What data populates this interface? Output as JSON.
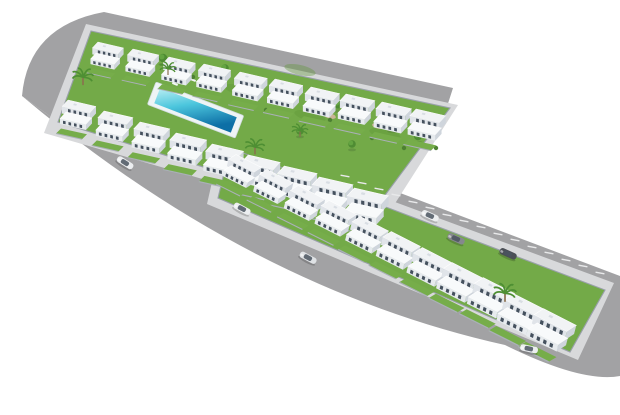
{
  "scene": {
    "description": "Aerial 3D architectural rendering of a modern white residential development: an upper block with two rows of villas around a communal lawn and rectangular swimming pool, a lower terrace row of townhouses with a rear parking lane, all wrapped by wide gray roads with rounded corners on a plain white ground, with a few cars and palm trees",
    "view": "aerial-perspective",
    "counts": {
      "villas_back_row": 10,
      "villas_front_row": 9,
      "townhouses": 11,
      "parking_space_lines": 16,
      "cars": 7,
      "palm_trees": 5,
      "garden_trees": 8,
      "pools": 1
    }
  },
  "colors": {
    "background": "#ffffff",
    "road": "#a2a2a4",
    "sidewalk": "#d8d9db",
    "lawn": "#73aa48",
    "lawn_shade": "#5f9638",
    "pool_deck": "#eef4f5",
    "pool_shallow": "#b9eef3",
    "pool_mid": "#4cc6dd",
    "pool_deep": "#0d6fa6",
    "house_roof": "#f1f3f5",
    "house_face": "#e0e4e9",
    "house_side": "#cfd5dc",
    "terrace_roof": "#f8fafb",
    "terrace_face": "#e7ebee",
    "window": "#45515e",
    "parking_line": "#e8e9ea",
    "tree_dark": "#4f8c33",
    "tree_light": "#63a441",
    "palm_frond": "#4e8f33",
    "palm_trunk": "#8a6f4e",
    "bush": "#4d8032",
    "dirt": "#c9b497",
    "car_white": "#eceef0",
    "car_silver": "#dfe2e5",
    "car_gray": "#85888d",
    "car_dark": "#4b4f56"
  },
  "items": {
    "villas_back": [
      {
        "x": 96,
        "y": 42,
        "s": 0.92
      },
      {
        "x": 131,
        "y": 49,
        "s": 0.93
      },
      {
        "x": 167,
        "y": 57,
        "s": 0.95
      },
      {
        "x": 202,
        "y": 64,
        "s": 0.96
      },
      {
        "x": 238,
        "y": 72,
        "s": 0.98
      },
      {
        "x": 273,
        "y": 79,
        "s": 1.0
      },
      {
        "x": 309,
        "y": 87,
        "s": 1.02
      },
      {
        "x": 344,
        "y": 94,
        "s": 1.03
      },
      {
        "x": 380,
        "y": 102,
        "s": 1.05
      },
      {
        "x": 414,
        "y": 109,
        "s": 1.06
      }
    ],
    "villas_front": [
      {
        "x": 66,
        "y": 100,
        "s": 1.0
      },
      {
        "x": 102,
        "y": 111,
        "s": 1.03
      },
      {
        "x": 138,
        "y": 122,
        "s": 1.06
      },
      {
        "x": 174,
        "y": 133,
        "s": 1.09
      },
      {
        "x": 210,
        "y": 144,
        "s": 1.12
      },
      {
        "x": 246,
        "y": 155,
        "s": 1.14
      },
      {
        "x": 282,
        "y": 166,
        "s": 1.17
      },
      {
        "x": 317,
        "y": 177,
        "s": 1.2
      },
      {
        "x": 352,
        "y": 188,
        "s": 1.22
      }
    ],
    "townhouses": [
      {
        "x": 234,
        "y": 154,
        "s": 1.0,
        "r": 14
      },
      {
        "x": 265,
        "y": 169,
        "s": 1.03,
        "r": 14
      },
      {
        "x": 296,
        "y": 185,
        "s": 1.06,
        "r": 14
      },
      {
        "x": 327,
        "y": 200,
        "s": 1.08,
        "r": 14
      },
      {
        "x": 358,
        "y": 216,
        "s": 1.11,
        "r": 14
      },
      {
        "x": 389,
        "y": 231,
        "s": 1.14,
        "r": 14
      },
      {
        "x": 420,
        "y": 247,
        "s": 1.17,
        "r": 14
      },
      {
        "x": 450,
        "y": 262,
        "s": 1.2,
        "r": 14
      },
      {
        "x": 481,
        "y": 277,
        "s": 1.22,
        "r": 14
      },
      {
        "x": 511,
        "y": 293,
        "s": 1.25,
        "r": 14
      },
      {
        "x": 541,
        "y": 308,
        "s": 1.28,
        "r": 14
      }
    ],
    "parking_lines": [
      {
        "x": 345,
        "y": 176,
        "r": 100
      },
      {
        "x": 362,
        "y": 183,
        "r": 100
      },
      {
        "x": 379,
        "y": 189,
        "r": 100
      },
      {
        "x": 396,
        "y": 195,
        "r": 100
      },
      {
        "x": 413,
        "y": 202,
        "r": 100
      },
      {
        "x": 430,
        "y": 208,
        "r": 100
      },
      {
        "x": 447,
        "y": 215,
        "r": 100
      },
      {
        "x": 464,
        "y": 221,
        "r": 100
      },
      {
        "x": 481,
        "y": 227,
        "r": 100
      },
      {
        "x": 498,
        "y": 234,
        "r": 100
      },
      {
        "x": 515,
        "y": 240,
        "r": 100
      },
      {
        "x": 532,
        "y": 247,
        "r": 100
      },
      {
        "x": 549,
        "y": 253,
        "r": 100
      },
      {
        "x": 566,
        "y": 260,
        "r": 100
      },
      {
        "x": 583,
        "y": 266,
        "r": 100
      },
      {
        "x": 600,
        "y": 273,
        "r": 100
      }
    ],
    "cars": [
      {
        "x": 125,
        "y": 163,
        "r": 32,
        "c": "#eceef0"
      },
      {
        "x": 242,
        "y": 209,
        "r": 28,
        "c": "#eceef0"
      },
      {
        "x": 308,
        "y": 258,
        "r": 28,
        "c": "#dfe2e5"
      },
      {
        "x": 430,
        "y": 216,
        "r": 24,
        "c": "#eceef0"
      },
      {
        "x": 456,
        "y": 239,
        "r": 24,
        "c": "#85888d"
      },
      {
        "x": 508,
        "y": 254,
        "r": 24,
        "c": "#4b4f56"
      },
      {
        "x": 529,
        "y": 349,
        "r": 12,
        "c": "#eceef0"
      }
    ],
    "palms": [
      {
        "x": 83,
        "y": 76,
        "s": 1.3
      },
      {
        "x": 168,
        "y": 68,
        "s": 1.0
      },
      {
        "x": 255,
        "y": 146,
        "s": 1.2
      },
      {
        "x": 300,
        "y": 130,
        "s": 1.0
      },
      {
        "x": 505,
        "y": 292,
        "s": 1.4
      }
    ],
    "trees": [
      {
        "x": 163,
        "y": 58,
        "s": 1.0
      },
      {
        "x": 225,
        "y": 68,
        "s": 0.9
      },
      {
        "x": 285,
        "y": 96,
        "s": 1.0
      },
      {
        "x": 338,
        "y": 104,
        "s": 1.1
      },
      {
        "x": 300,
        "y": 131,
        "s": 0.9
      },
      {
        "x": 392,
        "y": 124,
        "s": 1.1
      },
      {
        "x": 352,
        "y": 144,
        "s": 0.9
      },
      {
        "x": 418,
        "y": 136,
        "s": 1.0
      }
    ],
    "bushes": [
      {
        "x": 193,
        "y": 77
      },
      {
        "x": 210,
        "y": 97
      },
      {
        "x": 266,
        "y": 110
      },
      {
        "x": 330,
        "y": 120
      },
      {
        "x": 372,
        "y": 138
      },
      {
        "x": 404,
        "y": 148
      },
      {
        "x": 436,
        "y": 148
      }
    ],
    "dirt_patches": [
      {
        "x": 240,
        "y": 84,
        "r": 13
      },
      {
        "x": 330,
        "y": 116,
        "r": 13
      },
      {
        "x": 378,
        "y": 126,
        "r": 13
      }
    ],
    "lawn_patches": [
      {
        "x": 170,
        "y": 103,
        "r": 13
      },
      {
        "x": 240,
        "y": 90,
        "r": 13
      },
      {
        "x": 310,
        "y": 116,
        "r": 13
      },
      {
        "x": 385,
        "y": 134,
        "r": 13
      },
      {
        "x": 300,
        "y": 70,
        "r": 13
      }
    ],
    "loungers": [
      {
        "x": 175,
        "y": 84,
        "r": 20
      },
      {
        "x": 184,
        "y": 82,
        "r": 20
      },
      {
        "x": 193,
        "y": 80,
        "r": 20
      }
    ]
  }
}
